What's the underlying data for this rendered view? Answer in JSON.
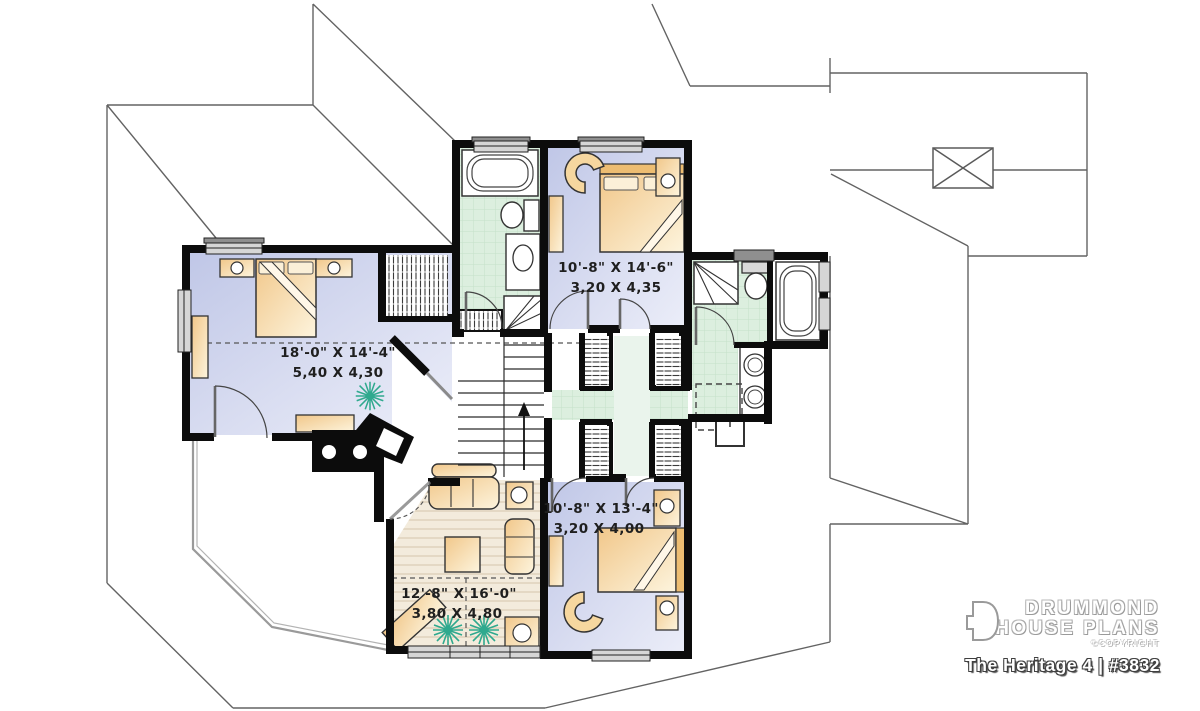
{
  "plan": {
    "title": "The Heritage 4 | #3832",
    "brand": {
      "name_line1": "DRUMMOND",
      "name_line2": "HOUSE PLANS",
      "copyright": "©COPYRIGHT"
    },
    "rooms": [
      {
        "name": "master-bedroom",
        "imperial": "18'-0\" X 14'-4\"",
        "metric": "5,40 X 4,30"
      },
      {
        "name": "bedroom-top",
        "imperial": "10'-8\" X 14'-6\"",
        "metric": "3,20 X 4,35"
      },
      {
        "name": "bedroom-bottom",
        "imperial": "10'-8\" X 13'-4\"",
        "metric": "3,20 X 4,00"
      },
      {
        "name": "family-room",
        "imperial": "12'-8\" X 16'-0\"",
        "metric": "3,80 X 4,80"
      }
    ],
    "stairs_direction": "up",
    "colors": {
      "bedroom_floor": "#c4cbe9",
      "bathroom_floor": "#dcefdf",
      "wood_floor": "#f3ebdc",
      "furniture": "#f2c98e",
      "wall": "#0c0c0c",
      "plant": "#2fa98e",
      "roof_line": "#636363"
    }
  }
}
